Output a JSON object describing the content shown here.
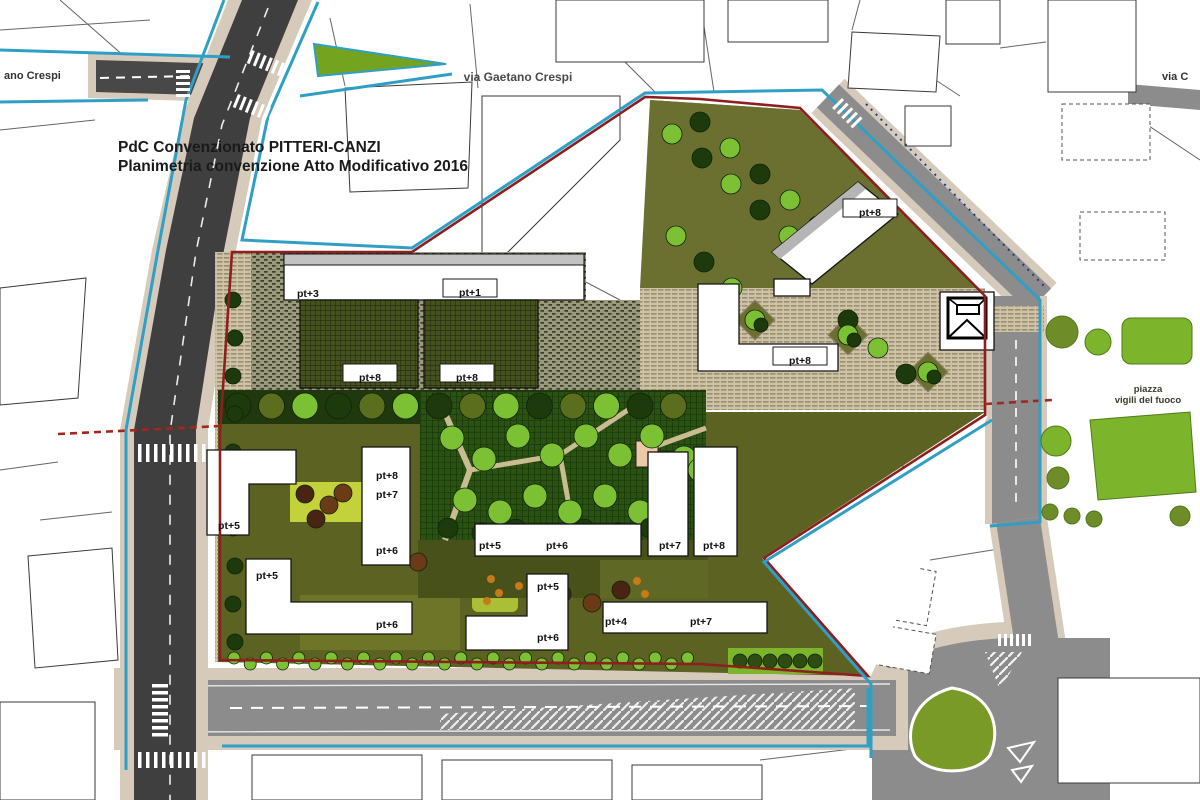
{
  "map": {
    "title_line1": "PdC Convenzionato PITTERI-CANZI",
    "title_line2": "Planimetria convenzione Atto Modificativo 2016",
    "streets": {
      "via_gaetano_crespi": "via Gaetano Crespi",
      "via_gaetano_crespi_left": "ano Crespi",
      "via_right": "via C",
      "piazza_line1": "piazza",
      "piazza_line2": "vigili del fuoco"
    },
    "building_labels": [
      {
        "label": "pt+3",
        "x": 297,
        "y": 293,
        "anchor": "start",
        "boxed": false
      },
      {
        "label": "pt+1",
        "x": 470,
        "y": 292,
        "anchor": "middle",
        "boxed": true
      },
      {
        "label": "pt+8",
        "x": 370,
        "y": 377,
        "anchor": "middle",
        "boxed": true
      },
      {
        "label": "pt+8",
        "x": 467,
        "y": 377,
        "anchor": "middle",
        "boxed": true
      },
      {
        "label": "pt+8",
        "x": 870,
        "y": 212,
        "anchor": "middle",
        "boxed": true
      },
      {
        "label": "pt+8",
        "x": 800,
        "y": 360,
        "anchor": "middle",
        "boxed": true
      },
      {
        "label": "pt+5",
        "x": 229,
        "y": 525,
        "anchor": "middle",
        "boxed": false
      },
      {
        "label": "pt+8",
        "x": 387,
        "y": 475,
        "anchor": "middle",
        "boxed": false
      },
      {
        "label": "pt+7",
        "x": 387,
        "y": 494,
        "anchor": "middle",
        "boxed": false
      },
      {
        "label": "pt+6",
        "x": 387,
        "y": 550,
        "anchor": "middle",
        "boxed": false
      },
      {
        "label": "pt+5",
        "x": 267,
        "y": 575,
        "anchor": "middle",
        "boxed": false
      },
      {
        "label": "pt+6",
        "x": 387,
        "y": 624,
        "anchor": "middle",
        "boxed": false
      },
      {
        "label": "pt+5",
        "x": 490,
        "y": 545,
        "anchor": "middle",
        "boxed": false
      },
      {
        "label": "pt+6",
        "x": 557,
        "y": 545,
        "anchor": "middle",
        "boxed": false
      },
      {
        "label": "pt+7",
        "x": 670,
        "y": 545,
        "anchor": "middle",
        "boxed": false
      },
      {
        "label": "pt+8",
        "x": 714,
        "y": 545,
        "anchor": "middle",
        "boxed": false
      },
      {
        "label": "pt+5",
        "x": 548,
        "y": 586,
        "anchor": "middle",
        "boxed": false
      },
      {
        "label": "pt+6",
        "x": 548,
        "y": 637,
        "anchor": "middle",
        "boxed": false
      },
      {
        "label": "pt+4",
        "x": 616,
        "y": 621,
        "anchor": "middle",
        "boxed": false
      },
      {
        "label": "pt+7",
        "x": 701,
        "y": 621,
        "anchor": "middle",
        "boxed": false
      }
    ],
    "colors": {
      "boundary_blue": "#2f9fc6",
      "boundary_red": "#8e1f1f",
      "red_dashed": "#a3271f",
      "navy_dotted": "#223a8c",
      "road_dark": "#3f3f3f",
      "road_gray": "#8c8c8c",
      "sidewalk": "#d6cabb",
      "park_green": "#2a5312",
      "park_band": "#20380e",
      "tree_bright": "#7cc133",
      "tree_dark": "#1d3a0c",
      "tree_olive": "#5a6e1d",
      "tree_maroon": "#4a2413",
      "tree_brown": "#6b3a16",
      "orange_dot": "#c87a18",
      "olive_ground": "#6b7030",
      "courtyard_olive": "#5c6222",
      "grass_bright": "#7cb52c",
      "yellow_green": "#c3d23a",
      "building_fill": "#ffffff"
    }
  }
}
